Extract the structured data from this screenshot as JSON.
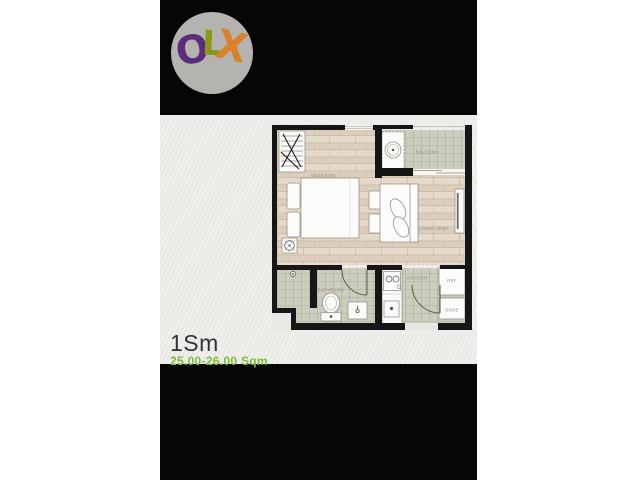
{
  "logo": {
    "name": "OLX",
    "circle_color": "#b5b3b0",
    "letters": [
      {
        "char": "O",
        "color": "#5b2b7f"
      },
      {
        "char": "L",
        "color": "#8a9912"
      },
      {
        "char": "X",
        "color": "#d9822a"
      }
    ]
  },
  "floorplan": {
    "labels": {
      "bedroom": "BEDROOM",
      "balcony": "BALCONY",
      "living": "LIVING AREA",
      "bathroom": "BATHROOM",
      "kitchen": "KITCHEN",
      "ref": "REF",
      "shoe": "SHOE"
    },
    "colors": {
      "wall": "#161616",
      "wood_floor": "#dccebd",
      "tile_floor": "#cdcdbe",
      "furniture": "#fbfbfa"
    }
  },
  "caption": {
    "unit_type": "1Sm",
    "area": "25.00-26.00 Sqm",
    "area_color": "#79bd3a"
  },
  "background": {
    "page": "#ffffff",
    "photo": "#060606",
    "paper": "#eae9e6"
  }
}
